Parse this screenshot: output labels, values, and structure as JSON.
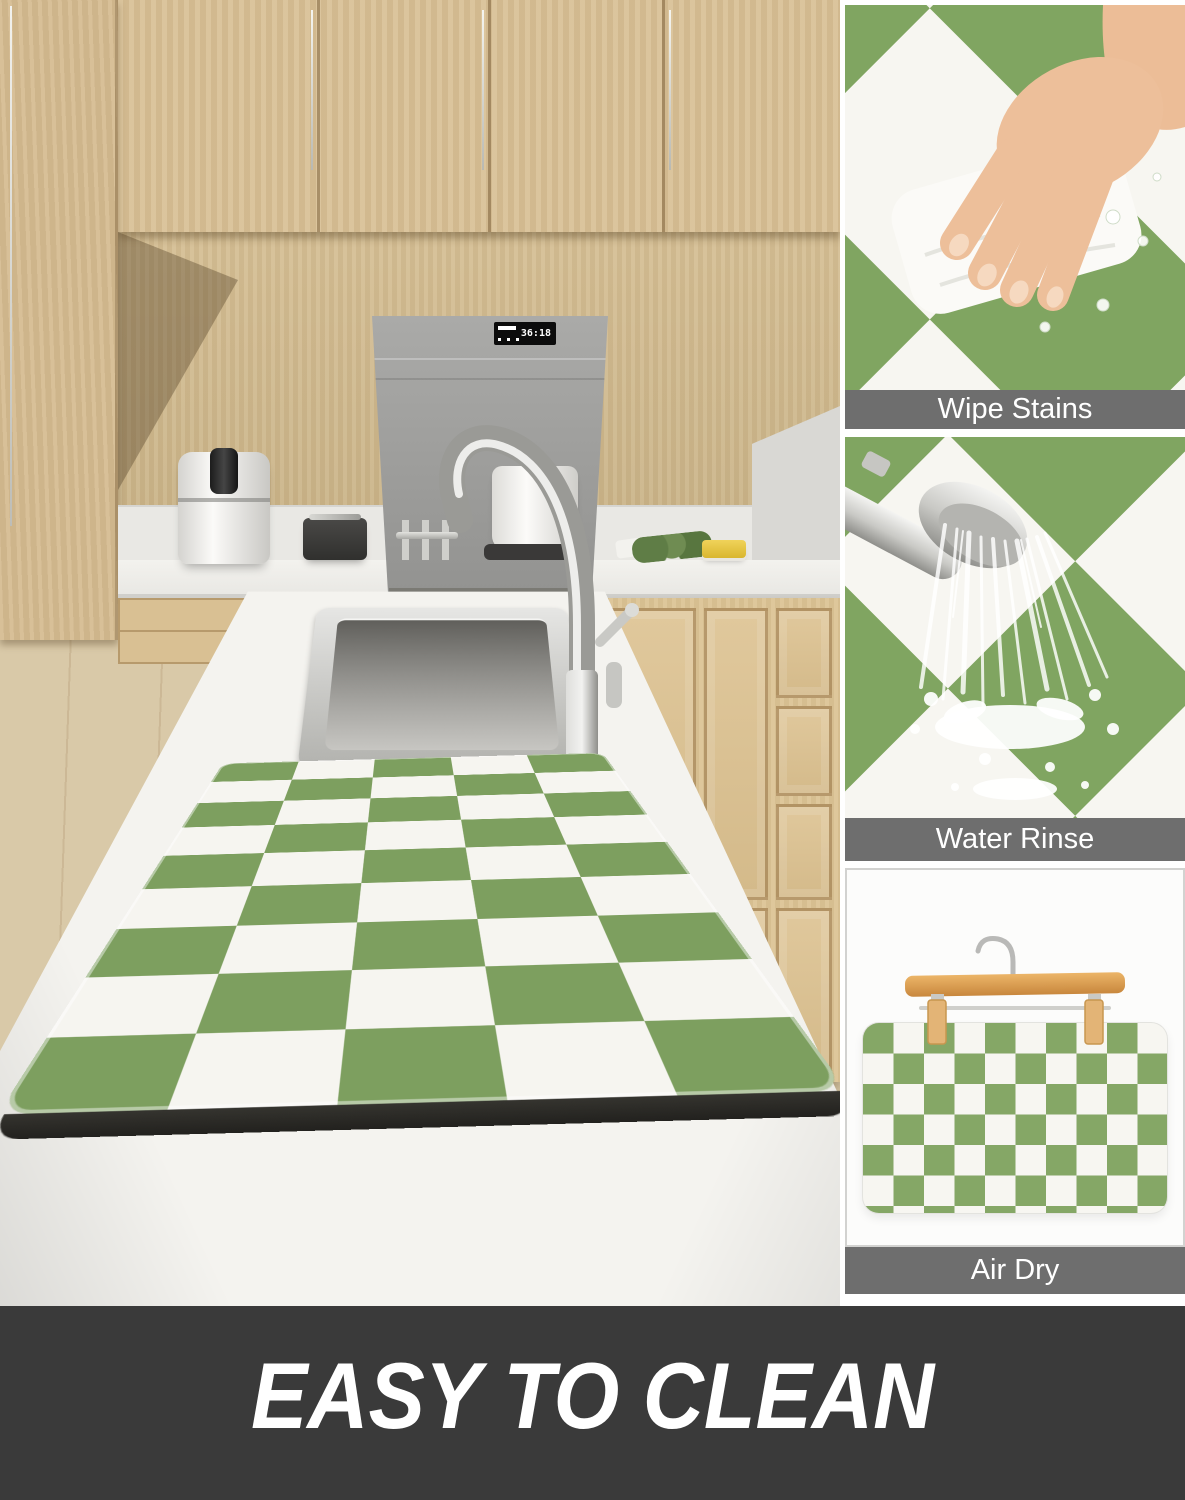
{
  "side_panels": [
    {
      "label": "Wipe Stains"
    },
    {
      "label": "Water Rinse"
    },
    {
      "label": "Air Dry"
    }
  ],
  "banner": {
    "title": "EASY TO CLEAN"
  },
  "kitchen": {
    "hood_display": "36:18"
  },
  "illustrations": {
    "panel1": "hand-wiping-mat-with-cloth",
    "panel2": "shower-head-rinsing-mat",
    "panel3": "checkered-mat-on-wooden-hanger",
    "main": "kitchen-island-with-green-checkered-drying-mat"
  },
  "colors": {
    "mat_green": "#7d9f5f",
    "mat_white": "#f6f5f0",
    "label_bar_gray": "#6e6e6e",
    "banner_bg": "#3a3a3a",
    "cabinet_wood": "#d9c197",
    "hanger_wood": "#e0a455",
    "foam_base_black": "#2b2a27"
  }
}
